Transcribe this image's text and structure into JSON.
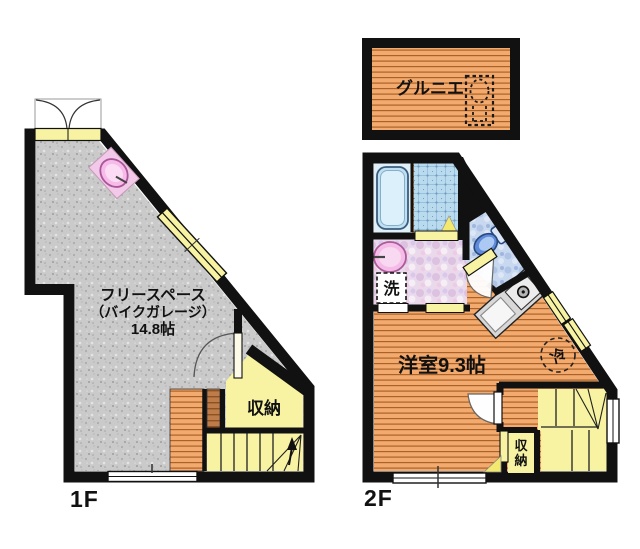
{
  "document": {
    "type": "japanese-floor-plan",
    "floors_shown": [
      "1F",
      "2F",
      "attic"
    ]
  },
  "labels": {
    "floor_1": "1F",
    "floor_2": "2F",
    "attic": "グルニエ",
    "free_space_1": "フリースペース",
    "free_space_2": "（バイクガレージ）",
    "free_space_3": "14.8帖",
    "storage_1f": "収納",
    "bedroom": "洋室9.3帖",
    "laundry": "洗",
    "fridge": "冷",
    "storage_2f_char_1": "収",
    "storage_2f_char_2": "納"
  },
  "areas": {
    "free_space_size": "14.8帖",
    "bedroom_size": "9.3帖"
  },
  "fixtures": [
    "entrance-double-door",
    "utility-sink",
    "deck-step",
    "staircase-1f",
    "storage-closet-1f",
    "bathtub",
    "shower-room",
    "washbasin",
    "washing-machine-space",
    "toilet",
    "kitchen-counter",
    "stove-burner",
    "refrigerator-space",
    "staircase-2f",
    "storage-closet-2f",
    "attic-ladder-hatch",
    "windows",
    "door-swing-arcs"
  ],
  "colors": {
    "wall": "#111111",
    "wood_floor": "#f3aa6e",
    "wood_stripe": "#aa6228",
    "garage_floor": "#cacaca",
    "tatami_yellow": "#f7f3a3",
    "door_wedge_yellow": "#f2e96e",
    "tile_blue": "#badaed",
    "washroom_pink": "#ead9eb",
    "toilet_floor_blue": "#c7d8ef",
    "toilet_bowl_blue": "#5e8ad9",
    "fixture_pink": "#f4bce6",
    "deck_brown": "#bd7c4a",
    "attic_text": "#3d2518"
  }
}
